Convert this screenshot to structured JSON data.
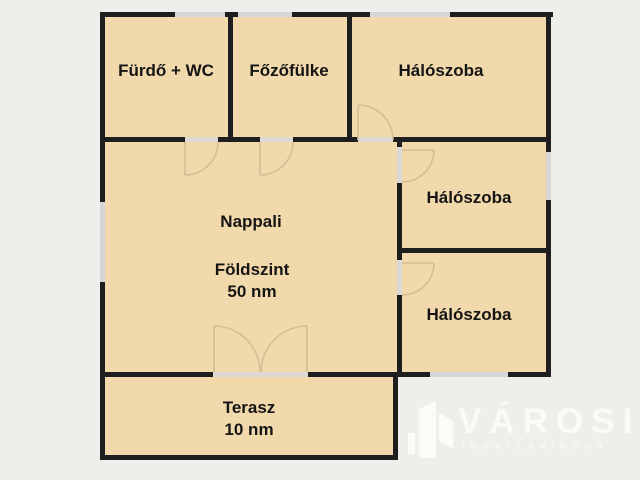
{
  "plan": {
    "rooms": {
      "furdo": {
        "label": "Fürdő + WC"
      },
      "fozofulke": {
        "label": "Főzőfülke"
      },
      "haloszoba1": {
        "label": "Hálószoba"
      },
      "haloszoba2": {
        "label": "Hálószoba"
      },
      "haloszoba3": {
        "label": "Hálószoba"
      },
      "nappali": {
        "label": "Nappali",
        "floor_label": "Földszint",
        "area_label": "50 nm"
      },
      "terasz": {
        "label": "Terasz",
        "area_label": "10 nm"
      }
    },
    "colors": {
      "room_fill": "#f2d9ab",
      "wall": "#1e1e1e",
      "background": "#f0eeea",
      "window": "#d6d6d6",
      "door_arc": "#d2bf96",
      "watermark": "#fbfaf6"
    }
  },
  "watermark": {
    "name": "VÁROSI",
    "subtitle": "INGATLANIRODA"
  }
}
